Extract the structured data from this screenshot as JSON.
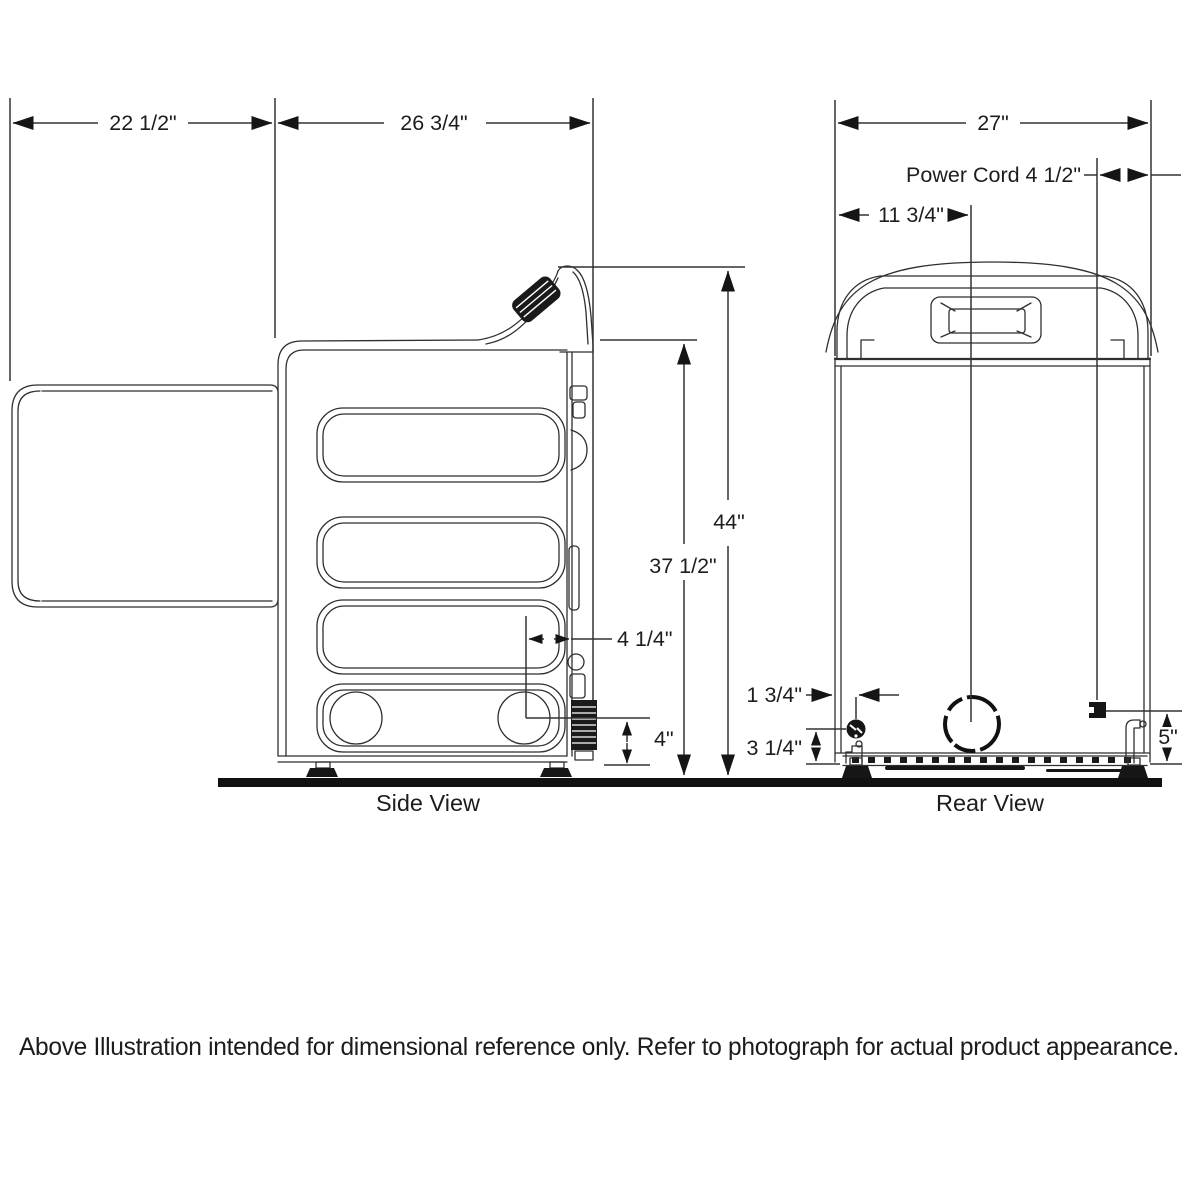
{
  "views": {
    "side": {
      "label": "Side View"
    },
    "rear": {
      "label": "Rear View"
    }
  },
  "dimensions": {
    "door_open_depth": "22 1/2\"",
    "total_depth": "26 3/4\"",
    "rear_width": "27\"",
    "power_cord": "Power Cord 4 1/2\"",
    "vent_offset": "11 3/4\"",
    "total_height": "44\"",
    "body_height": "37 1/2\"",
    "exhaust_from_back": "4 1/4\"",
    "exhaust_height": "4\"",
    "cord_from_left": "1 3/4\"",
    "cord_height": "3 1/4\"",
    "gas_connection_height": "5\"",
    "unit": "inches"
  },
  "footnote": "Above Illustration intended for dimensional reference only. Refer to photograph for actual product appearance.",
  "colors": {
    "line": "#2f2f2f",
    "solid": "#161616",
    "background": "#ffffff",
    "text": "#1d1d1d"
  }
}
